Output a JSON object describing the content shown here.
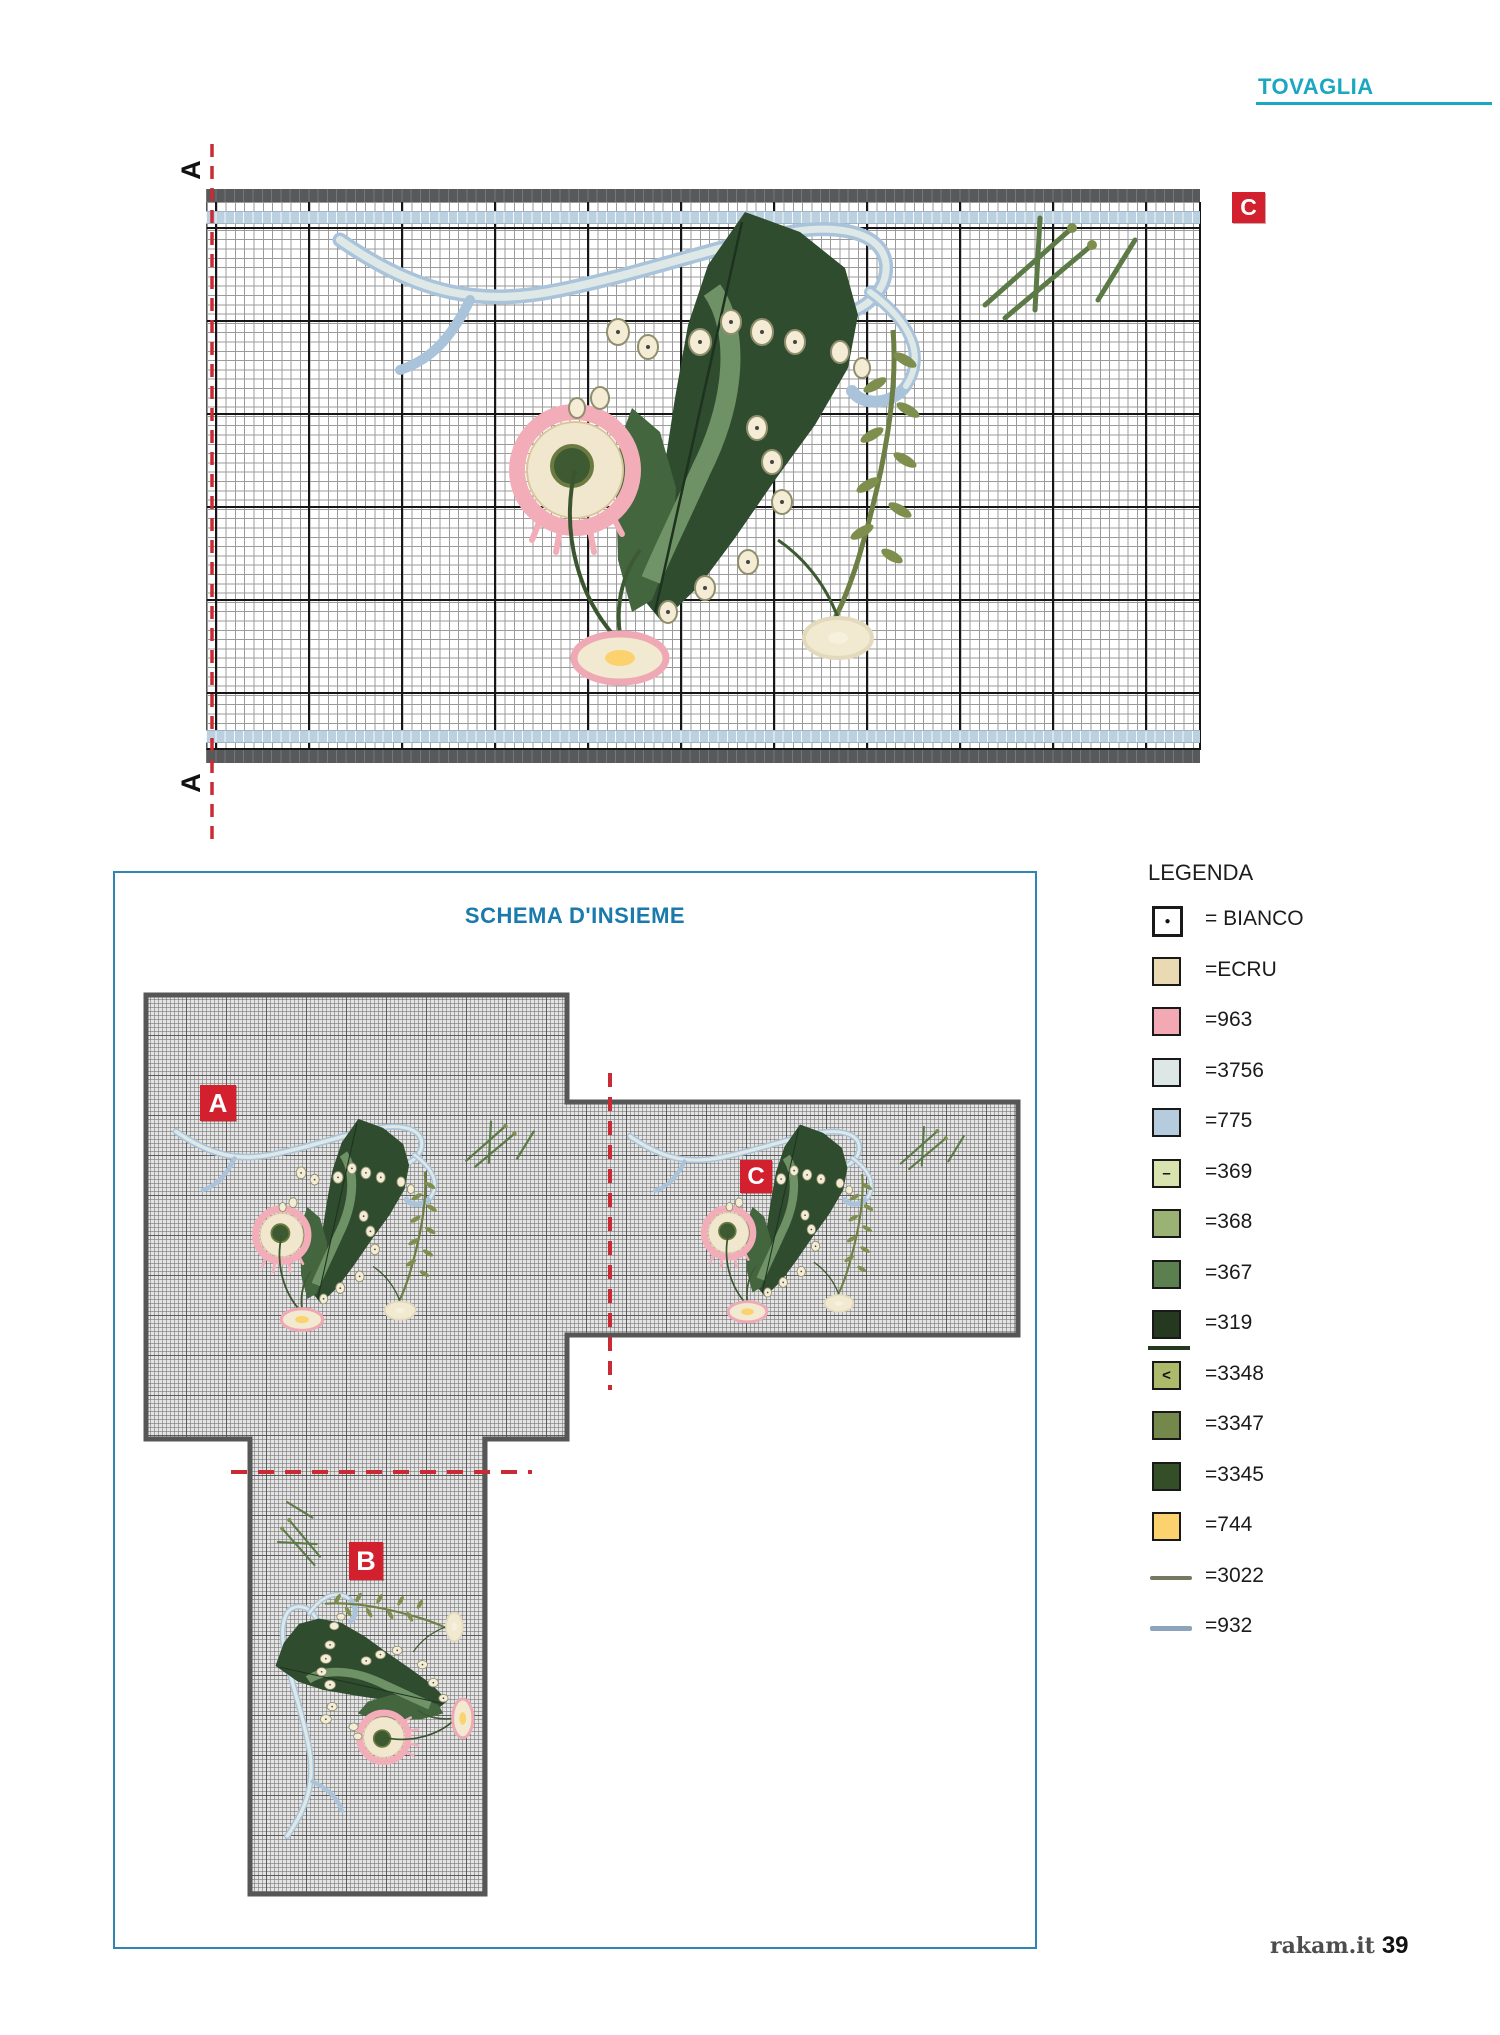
{
  "page": {
    "header": "TOVAGLIA",
    "footer_brand": "rakam.it",
    "footer_page": "39"
  },
  "main_chart": {
    "marker_top": "A",
    "marker_bottom": "A",
    "corner_label": "C",
    "subject": "cross-stitch chart: lily-of-the-valley bouquet with blue ribbon, pink wild rose and daisies on squared grid"
  },
  "schema": {
    "title": "SCHEMA D'INSIEME",
    "label_a": "A",
    "label_b": "B",
    "label_c": "C"
  },
  "legend": {
    "title": "LEGENDA",
    "items": [
      {
        "symbol": "●",
        "color": "#FFFFFF",
        "label": "= BIANCO"
      },
      {
        "color": "#E9DAB4",
        "label": "=ECRU"
      },
      {
        "color": "#F2A9B4",
        "label": "=963"
      },
      {
        "color": "#DDE7E6",
        "label": "=3756"
      },
      {
        "color": "#B5CBDE",
        "label": "=775"
      },
      {
        "symbol": "–",
        "color": "#D9E3B0",
        "label": "=369"
      },
      {
        "color": "#9AB273",
        "label": "=368"
      },
      {
        "color": "#5C7F50",
        "label": "=367"
      },
      {
        "color": "#24391F",
        "label": "=319",
        "underline": true
      },
      {
        "symbol": "<",
        "color": "#ADBA6C",
        "label": "=3348"
      },
      {
        "color": "#75884C",
        "label": "=3347"
      },
      {
        "color": "#344E28",
        "label": "=3345"
      },
      {
        "color": "#FBD26E",
        "label": "=744"
      },
      {
        "type": "line",
        "color": "#76795F",
        "label": "=3022"
      },
      {
        "type": "line",
        "color": "#8CA4BC",
        "label": "=932"
      }
    ]
  },
  "colors": {
    "accent_teal": "#1AA7BF",
    "schema_title_blue": "#1A7AAB",
    "schema_border_blue": "#2E86B3",
    "label_red": "#D2202F",
    "dash_red": "#C92B35",
    "chart_bar_gray": "#58595B",
    "border_row_blue": "#BCD1DF"
  }
}
